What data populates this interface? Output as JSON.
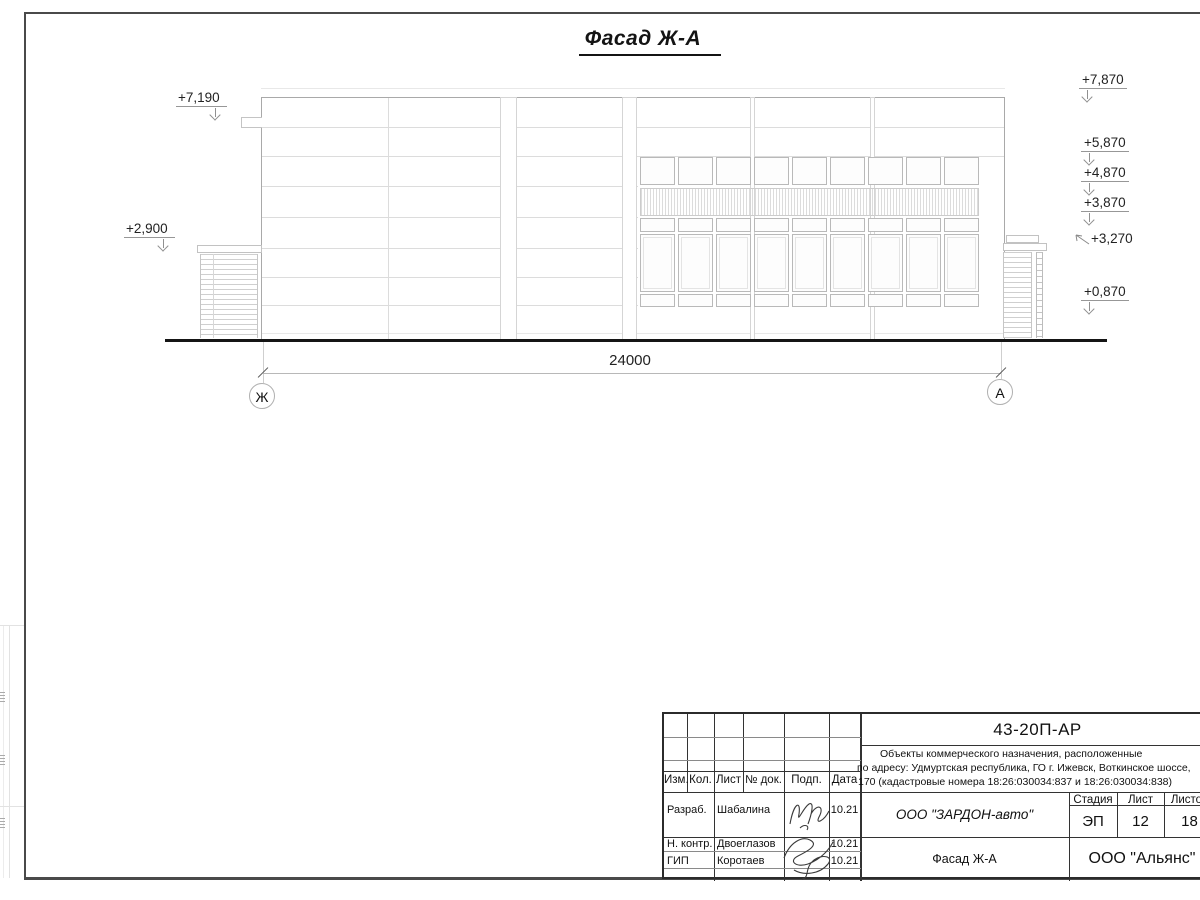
{
  "drawing": {
    "title": "Фасад Ж-А",
    "dimension": {
      "value": "24000"
    },
    "axes": [
      {
        "label": "Ж"
      },
      {
        "label": "А"
      }
    ],
    "elevations_left": [
      {
        "value": "+7,190"
      },
      {
        "value": "+2,900"
      }
    ],
    "elevations_right": [
      {
        "value": "+7,870"
      },
      {
        "value": "+5,870"
      },
      {
        "value": "+4,870"
      },
      {
        "value": "+3,870"
      },
      {
        "value": "+3,270"
      },
      {
        "value": "+0,870"
      }
    ]
  },
  "title_block": {
    "doc_number": "43-20П-АР",
    "project_description": [
      "Объекты коммерческого назначения, расположенные",
      "по адресу: Удмуртская республика, ГО г. Ижевск, Воткинское шоссе,",
      "170 (кадастровые номера 18:26:030034:837 и 18:26:030034:838)"
    ],
    "columns": {
      "izm": "Изм.",
      "kol": "Кол.",
      "list": "Лист",
      "doc": "№ док.",
      "podp": "Подп.",
      "data": "Дата"
    },
    "rows": [
      {
        "role": "Разраб.",
        "name": "Шабалина",
        "date": "10.21"
      },
      {
        "role": "Н. контр.",
        "name": "Двоеглазов",
        "date": "10.21"
      },
      {
        "role": "ГИП",
        "name": "Коротаев",
        "date": "10.21"
      }
    ],
    "company": "ООО \"ЗАРДОН-авто\"",
    "stage_label": "Стадия",
    "sheet_label": "Лист",
    "sheets_label": "Листов",
    "stage": "ЭП",
    "sheet": "12",
    "sheets": "18",
    "sheet_title": "Фасад Ж-А",
    "contractor": "ООО \"Альянс\""
  }
}
